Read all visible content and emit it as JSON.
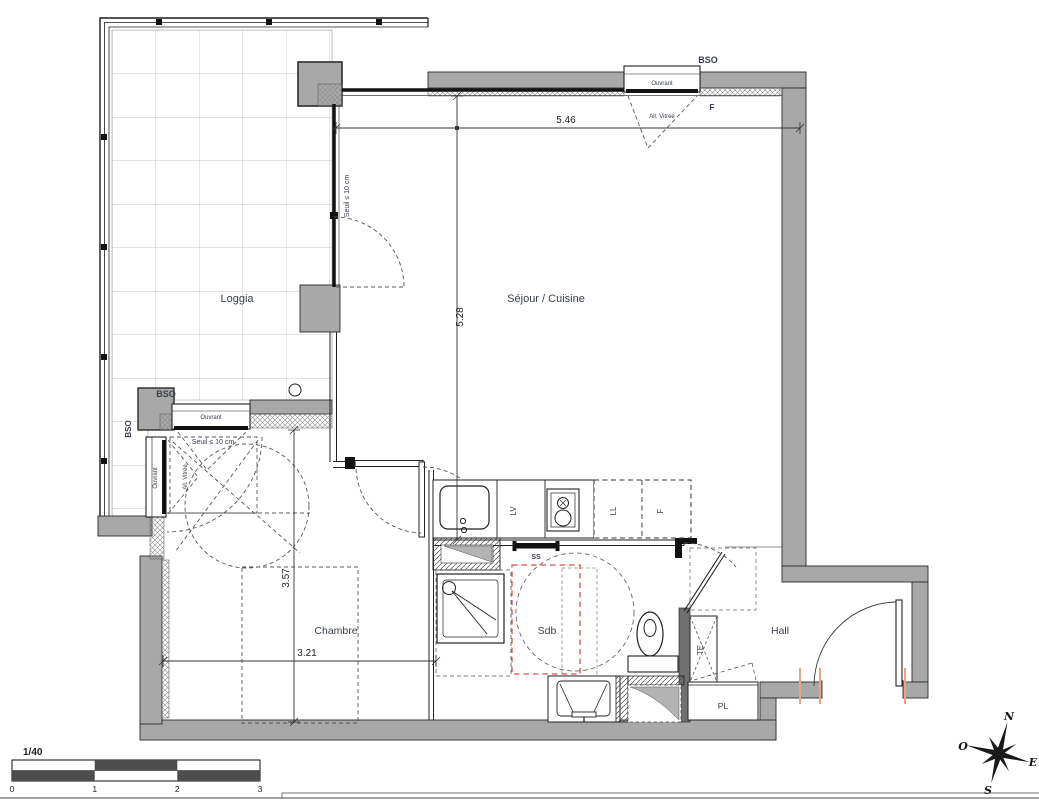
{
  "plan": {
    "rooms": {
      "loggia": "Loggia",
      "sejour": "Séjour / Cuisine",
      "chambre": "Chambre",
      "sdb": "Sdb",
      "hall": "Hall",
      "pl": "PL",
      "te": "TE"
    },
    "kitchen": {
      "lv": "LV",
      "ll": "LL",
      "f": "F",
      "ss": "SS"
    },
    "openings": {
      "bso": "BSO",
      "ouvrant": "Ouvrant",
      "f_window": "F",
      "all_vitree": "All. Vitrée",
      "seuil": "Seuil ≤ 10 cm"
    },
    "dimensions": {
      "sejour_width": "5.46",
      "sejour_depth": "5.28",
      "chambre_depth": "3.57",
      "chambre_width": "3.21"
    },
    "scale_bar": {
      "ratio": "1/40",
      "ticks": [
        "0",
        "1",
        "2",
        "3"
      ]
    },
    "compass": {
      "n": "N",
      "e": "E",
      "s": "S",
      "o": "O"
    },
    "colors": {
      "wall_fill": "#a8a8a8",
      "accessibility_zone": "#e14b4b",
      "jamb_marker": "#eda380"
    }
  }
}
